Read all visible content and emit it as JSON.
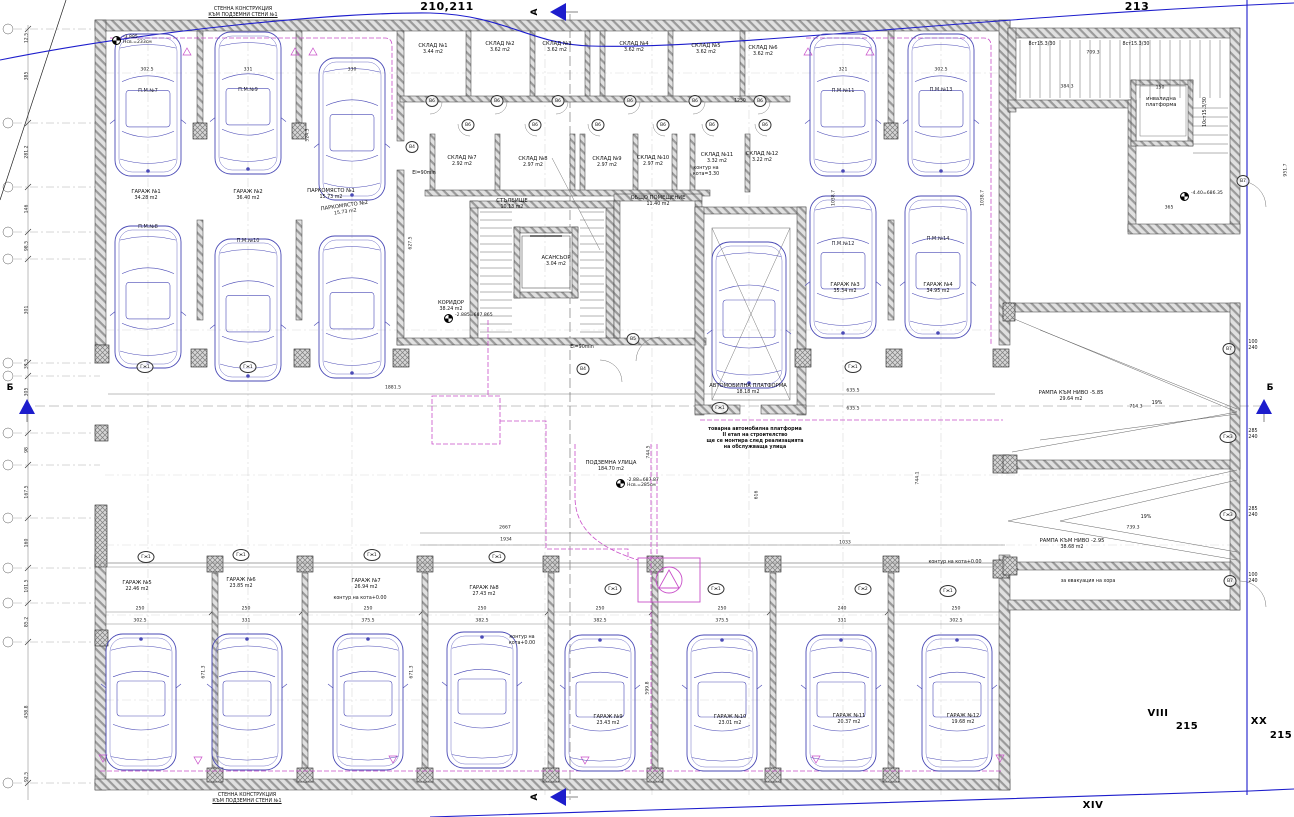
{
  "colors": {
    "car": "#4a4ab6",
    "duct": "#c94fc9",
    "boundary": "#1d1dcc",
    "wall_hatch": "#9a9a9a",
    "line": "#444444"
  },
  "plot_labels": [
    {
      "text": "210,211",
      "x": 447,
      "y": 0,
      "size": 11
    },
    {
      "text": "213",
      "x": 1137,
      "y": 0,
      "size": 11
    },
    {
      "text": "VIII",
      "x": 1158,
      "y": 708,
      "size": 10
    },
    {
      "text": "215",
      "x": 1187,
      "y": 721,
      "size": 10
    },
    {
      "text": "XX",
      "x": 1259,
      "y": 716,
      "size": 10
    },
    {
      "text": "215",
      "x": 1281,
      "y": 730,
      "size": 10
    },
    {
      "text": "XIV",
      "x": 1093,
      "y": 800,
      "size": 10
    }
  ],
  "section_markers": [
    {
      "label": "А",
      "lx": 535,
      "ly": 12,
      "tx": 556,
      "ty": 12,
      "dir": "left",
      "rot": true
    },
    {
      "label": "А",
      "lx": 535,
      "ly": 797,
      "tx": 556,
      "ty": 797,
      "dir": "left",
      "rot": true
    },
    {
      "label": "Б",
      "lx": 10,
      "ly": 388,
      "tx": 27,
      "ty": 406,
      "dir": "up",
      "rot": false
    },
    {
      "label": "Б",
      "lx": 1270,
      "ly": 388,
      "tx": 1264,
      "ty": 406,
      "dir": "up",
      "rot": false
    }
  ],
  "rooms": [
    {
      "name": "СКЛАД №1",
      "area": "3.44 m2",
      "x": 433,
      "y": 44
    },
    {
      "name": "СКЛАД №2",
      "area": "3.62 m2",
      "x": 500,
      "y": 42
    },
    {
      "name": "СКЛАД №3",
      "area": "3.62 m2",
      "x": 557,
      "y": 42
    },
    {
      "name": "СКЛАД №4",
      "area": "3.62 m2",
      "x": 634,
      "y": 42
    },
    {
      "name": "СКЛАД №5",
      "area": "3.62 m2",
      "x": 706,
      "y": 44
    },
    {
      "name": "СКЛАД №6",
      "area": "3.62 m2",
      "x": 763,
      "y": 46
    },
    {
      "name": "СКЛАД №7",
      "area": "2.92 m2",
      "x": 462,
      "y": 156
    },
    {
      "name": "СКЛАД №8",
      "area": "2.97 m2",
      "x": 533,
      "y": 157
    },
    {
      "name": "СКЛАД №9",
      "area": "2.97 m2",
      "x": 607,
      "y": 157
    },
    {
      "name": "СКЛАД №10",
      "area": "2.97 m2",
      "x": 653,
      "y": 156
    },
    {
      "name": "СКЛАД №11",
      "area": "3.32 m2",
      "x": 717,
      "y": 153
    },
    {
      "name": "СКЛАД №12",
      "area": "3.22 m2",
      "x": 762,
      "y": 152
    },
    {
      "name": "СТЪЛБИЩЕ",
      "area": "10.13 m2",
      "x": 512,
      "y": 199
    },
    {
      "name": "АСАНСЬОР",
      "area": "3.04 m2",
      "x": 556,
      "y": 256
    },
    {
      "name": "ОБЩО ПОМЕЩЕНИЕ",
      "area": "11.40 m2",
      "x": 658,
      "y": 196
    },
    {
      "name": "КОРИДОР",
      "area": "38.24 m2",
      "x": 451,
      "y": 301
    },
    {
      "name": "АВТОМОБИЛНА ПЛАТФОРМА",
      "area": "18.18 m2",
      "x": 748,
      "y": 384
    },
    {
      "name": "ПОДЗЕМНА УЛИЦА",
      "area": "184.70 m2",
      "x": 611,
      "y": 461
    },
    {
      "name": "РАМПА КЪМ НИВО -5.85",
      "area": "29.64 m2",
      "x": 1071,
      "y": 391
    },
    {
      "name": "РАМПА КЪМ НИВО -2.95",
      "area": "38.68 m2",
      "x": 1072,
      "y": 539
    },
    {
      "name": "ГАРАЖ №1",
      "area": "34.28 m2",
      "x": 146,
      "y": 190
    },
    {
      "name": "ГАРАЖ №2",
      "area": "36.40 m2",
      "x": 248,
      "y": 190
    },
    {
      "name": "ПАРКОМЯСТО №1",
      "area": "15.73 m2",
      "x": 331,
      "y": 189
    },
    {
      "name": "ПАРКОМЯСТО №2",
      "area": "15.73 m2",
      "x": 345,
      "y": 204,
      "rot": -8
    },
    {
      "name": "ГАРАЖ №3",
      "area": "35.34 m2",
      "x": 845,
      "y": 283
    },
    {
      "name": "ГАРАЖ №4",
      "area": "34.95 m2",
      "x": 938,
      "y": 283
    },
    {
      "name": "ГАРАЖ №5",
      "area": "22.46 m2",
      "x": 137,
      "y": 581
    },
    {
      "name": "ГАРАЖ №6",
      "area": "23.85 m2",
      "x": 241,
      "y": 578
    },
    {
      "name": "ГАРАЖ №7",
      "area": "26.94 m2",
      "x": 366,
      "y": 579
    },
    {
      "name": "ГАРАЖ №8",
      "area": "27.43 m2",
      "x": 484,
      "y": 586
    },
    {
      "name": "ГАРАЖ №9",
      "area": "23.43 m2",
      "x": 608,
      "y": 715
    },
    {
      "name": "ГАРАЖ №10",
      "area": "23.01 m2",
      "x": 730,
      "y": 715
    },
    {
      "name": "ГАРАЖ №11",
      "area": "20.37 m2",
      "x": 849,
      "y": 714
    },
    {
      "name": "ГАРАЖ №12",
      "area": "19.68 m2",
      "x": 963,
      "y": 714
    },
    {
      "name": "инвалидна\nплатформа",
      "area": "",
      "x": 1161,
      "y": 97
    }
  ],
  "cars": [
    {
      "cx": 148,
      "y": 32,
      "w": 66,
      "h": 146,
      "dir": "d",
      "label": "П.М.№7",
      "ly": 88
    },
    {
      "cx": 248,
      "y": 30,
      "w": 66,
      "h": 146,
      "dir": "d",
      "label": "П.М.№9",
      "ly": 87
    },
    {
      "cx": 352,
      "y": 56,
      "w": 66,
      "h": 146,
      "dir": "d",
      "label": "",
      "ly": 0
    },
    {
      "cx": 148,
      "y": 224,
      "w": 66,
      "h": 146,
      "dir": "d",
      "label": "П.М.№8",
      "ly": 224
    },
    {
      "cx": 248,
      "y": 237,
      "w": 66,
      "h": 146,
      "dir": "d",
      "label": "П.М.№10",
      "ly": 238
    },
    {
      "cx": 352,
      "y": 234,
      "w": 66,
      "h": 146,
      "dir": "d",
      "label": "",
      "ly": 0
    },
    {
      "cx": 843,
      "y": 32,
      "w": 66,
      "h": 146,
      "dir": "d",
      "label": "П.М.№11",
      "ly": 88
    },
    {
      "cx": 941,
      "y": 32,
      "w": 66,
      "h": 146,
      "dir": "d",
      "label": "П.М.№13",
      "ly": 87
    },
    {
      "cx": 843,
      "y": 194,
      "w": 66,
      "h": 146,
      "dir": "d",
      "label": "П.М.№12",
      "ly": 241
    },
    {
      "cx": 938,
      "y": 194,
      "w": 66,
      "h": 146,
      "dir": "d",
      "label": "П.М.№14",
      "ly": 236
    },
    {
      "cx": 749,
      "y": 240,
      "w": 74,
      "h": 150,
      "dir": "d",
      "label": "",
      "ly": 0
    },
    {
      "cx": 141,
      "y": 632,
      "w": 70,
      "h": 140,
      "dir": "u",
      "label": "",
      "ly": 0
    },
    {
      "cx": 247,
      "y": 632,
      "w": 70,
      "h": 140,
      "dir": "u",
      "label": "",
      "ly": 0
    },
    {
      "cx": 368,
      "y": 632,
      "w": 70,
      "h": 140,
      "dir": "u",
      "label": "",
      "ly": 0
    },
    {
      "cx": 482,
      "y": 630,
      "w": 70,
      "h": 140,
      "dir": "u",
      "label": "",
      "ly": 0
    },
    {
      "cx": 600,
      "y": 633,
      "w": 70,
      "h": 140,
      "dir": "u",
      "label": "",
      "ly": 0
    },
    {
      "cx": 722,
      "y": 633,
      "w": 70,
      "h": 140,
      "dir": "u",
      "label": "",
      "ly": 0
    },
    {
      "cx": 841,
      "y": 633,
      "w": 70,
      "h": 140,
      "dir": "u",
      "label": "",
      "ly": 0
    },
    {
      "cx": 957,
      "y": 633,
      "w": 70,
      "h": 140,
      "dir": "u",
      "label": "",
      "ly": 0
    }
  ],
  "door_tags": [
    {
      "t": "В6",
      "x": 432,
      "y": 101
    },
    {
      "t": "В6",
      "x": 497,
      "y": 101
    },
    {
      "t": "В6",
      "x": 558,
      "y": 101
    },
    {
      "t": "В6",
      "x": 630,
      "y": 101
    },
    {
      "t": "В6",
      "x": 695,
      "y": 101
    },
    {
      "t": "В6",
      "x": 760,
      "y": 101
    },
    {
      "t": "В6",
      "x": 468,
      "y": 125
    },
    {
      "t": "В6",
      "x": 535,
      "y": 125
    },
    {
      "t": "В6",
      "x": 598,
      "y": 125
    },
    {
      "t": "В6",
      "x": 663,
      "y": 125
    },
    {
      "t": "В6",
      "x": 712,
      "y": 125
    },
    {
      "t": "В6",
      "x": 765,
      "y": 125
    },
    {
      "t": "В4",
      "x": 412,
      "y": 147
    },
    {
      "t": "В4",
      "x": 583,
      "y": 369
    },
    {
      "t": "В5",
      "x": 633,
      "y": 339
    },
    {
      "t": "В7",
      "x": 1243,
      "y": 181
    },
    {
      "t": "В7",
      "x": 1229,
      "y": 349
    },
    {
      "t": "В7",
      "x": 1230,
      "y": 581
    },
    {
      "t": "Гж3",
      "x": 1228,
      "y": 437
    },
    {
      "t": "Гж3",
      "x": 1228,
      "y": 515
    },
    {
      "t": "Гж1",
      "x": 146,
      "y": 557
    },
    {
      "t": "Гж1",
      "x": 241,
      "y": 555
    },
    {
      "t": "Гж1",
      "x": 372,
      "y": 555
    },
    {
      "t": "Гж1",
      "x": 497,
      "y": 557
    },
    {
      "t": "Гж1",
      "x": 613,
      "y": 589
    },
    {
      "t": "Гж1",
      "x": 716,
      "y": 589
    },
    {
      "t": "Гж2",
      "x": 863,
      "y": 589
    },
    {
      "t": "Гж1",
      "x": 948,
      "y": 591
    },
    {
      "t": "Гж1",
      "x": 145,
      "y": 367
    },
    {
      "t": "Гж1",
      "x": 248,
      "y": 367
    },
    {
      "t": "Гж1",
      "x": 720,
      "y": 408
    },
    {
      "t": "Гж1",
      "x": 853,
      "y": 367
    }
  ],
  "elevation_marks": [
    {
      "v": "-3.885",
      "s": "Нсв.=233см",
      "x": 112,
      "y": 40
    },
    {
      "v": "-2.885=687.865",
      "s": "",
      "x": 444,
      "y": 318
    },
    {
      "v": "-2.88=687.87",
      "s": "Нсв.=285см",
      "x": 616,
      "y": 483
    },
    {
      "v": "-4.40=686.35",
      "s": "",
      "x": 1180,
      "y": 196
    }
  ],
  "notes": [
    {
      "text": "СТЕННА КОНСТРУКЦИЯ\nКЪМ ПОДЗЕМНИ СТЕНИ №1",
      "x": 243,
      "y": 7,
      "u": true
    },
    {
      "text": "СТЕННА КОНСТРУКЦИЯ\nКЪМ ПОДЗЕМНИ СТЕНИ №1",
      "x": 247,
      "y": 793,
      "u": true
    },
    {
      "text": "товарна автомобилна платформа\nII етап на строителство\nще се монтира след реализацията\nна обслужваща улица",
      "x": 755,
      "y": 427,
      "bold": true
    },
    {
      "text": "контур на\nкота=3.30",
      "x": 706,
      "y": 166
    },
    {
      "text": "контур на\nкота+0.00",
      "x": 522,
      "y": 635
    },
    {
      "text": "контур на кота+0.00",
      "x": 360,
      "y": 596
    },
    {
      "text": "контур на кота+0.00",
      "x": 955,
      "y": 560
    },
    {
      "text": "за евакуация на хора",
      "x": 1088,
      "y": 579
    },
    {
      "text": "EI=90min",
      "x": 424,
      "y": 171
    },
    {
      "text": "EI=90min",
      "x": 582,
      "y": 345
    },
    {
      "text": "8ст15.3/30",
      "x": 1042,
      "y": 42
    },
    {
      "text": "8ст15.3/30",
      "x": 1136,
      "y": 42
    },
    {
      "text": "10ст15.3/30",
      "x": 1206,
      "y": 112,
      "rot": true
    },
    {
      "text": "19%",
      "x": 1157,
      "y": 401
    },
    {
      "text": "19%",
      "x": 1146,
      "y": 515
    },
    {
      "text": "100\n240",
      "x": 1253,
      "y": 340
    },
    {
      "text": "285\n240",
      "x": 1253,
      "y": 429
    },
    {
      "text": "285\n240",
      "x": 1253,
      "y": 507
    },
    {
      "text": "100\n240",
      "x": 1253,
      "y": 573
    }
  ],
  "dimensions": [
    {
      "t": "1881.5",
      "x": 393,
      "y": 388
    },
    {
      "t": "635.5",
      "x": 853,
      "y": 391
    },
    {
      "t": "635.5",
      "x": 853,
      "y": 409
    },
    {
      "t": "2667",
      "x": 505,
      "y": 528
    },
    {
      "t": "1934",
      "x": 506,
      "y": 540
    },
    {
      "t": "1033",
      "x": 845,
      "y": 543
    },
    {
      "t": "714.3",
      "x": 1136,
      "y": 407
    },
    {
      "t": "739.3",
      "x": 1133,
      "y": 528
    },
    {
      "t": "384.3",
      "x": 1067,
      "y": 87
    },
    {
      "t": "709.3",
      "x": 1093,
      "y": 53
    },
    {
      "t": "365",
      "x": 1169,
      "y": 208
    },
    {
      "t": "1250",
      "x": 740,
      "y": 101
    },
    {
      "t": "150",
      "x": 1160,
      "y": 88
    },
    {
      "t": "744.5",
      "x": 649,
      "y": 452,
      "rot": true
    },
    {
      "t": "616",
      "x": 757,
      "y": 495,
      "rot": true
    },
    {
      "t": "744.1",
      "x": 918,
      "y": 478,
      "rot": true
    },
    {
      "t": "1038.7",
      "x": 834,
      "y": 198,
      "rot": true
    },
    {
      "t": "1038.7",
      "x": 983,
      "y": 198,
      "rot": true
    },
    {
      "t": "524.3",
      "x": 308,
      "y": 135,
      "rot": true
    },
    {
      "t": "627.5",
      "x": 411,
      "y": 243,
      "rot": true
    },
    {
      "t": "671.3",
      "x": 204,
      "y": 672,
      "rot": true
    },
    {
      "t": "671.3",
      "x": 412,
      "y": 672,
      "rot": true
    },
    {
      "t": "599.8",
      "x": 648,
      "y": 688,
      "rot": true
    },
    {
      "t": "951.7",
      "x": 1286,
      "y": 170,
      "rot": true
    },
    {
      "t": "12.5",
      "x": 27,
      "y": 38,
      "rot": true
    },
    {
      "t": "385",
      "x": 27,
      "y": 76,
      "rot": true
    },
    {
      "t": "281.2",
      "x": 27,
      "y": 152,
      "rot": true
    },
    {
      "t": "146",
      "x": 27,
      "y": 209,
      "rot": true
    },
    {
      "t": "98.5",
      "x": 27,
      "y": 246,
      "rot": true
    },
    {
      "t": "301",
      "x": 27,
      "y": 310,
      "rot": true
    },
    {
      "t": "37.5",
      "x": 27,
      "y": 364,
      "rot": true
    },
    {
      "t": "305",
      "x": 27,
      "y": 392,
      "rot": true
    },
    {
      "t": "98",
      "x": 27,
      "y": 450,
      "rot": true
    },
    {
      "t": "167.5",
      "x": 27,
      "y": 492,
      "rot": true
    },
    {
      "t": "160",
      "x": 27,
      "y": 543,
      "rot": true
    },
    {
      "t": "101.5",
      "x": 27,
      "y": 586,
      "rot": true
    },
    {
      "t": "85.2",
      "x": 27,
      "y": 622,
      "rot": true
    },
    {
      "t": "458.8",
      "x": 27,
      "y": 712,
      "rot": true
    },
    {
      "t": "92.5",
      "x": 27,
      "y": 777,
      "rot": true
    },
    {
      "t": "302.5",
      "x": 147,
      "y": 70
    },
    {
      "t": "331",
      "x": 248,
      "y": 70
    },
    {
      "t": "330",
      "x": 352,
      "y": 70
    },
    {
      "t": "321",
      "x": 843,
      "y": 70
    },
    {
      "t": "302.5",
      "x": 941,
      "y": 70
    },
    {
      "t": "250",
      "x": 140,
      "y": 609
    },
    {
      "t": "250",
      "x": 246,
      "y": 609
    },
    {
      "t": "250",
      "x": 368,
      "y": 609
    },
    {
      "t": "250",
      "x": 482,
      "y": 609
    },
    {
      "t": "250",
      "x": 600,
      "y": 609
    },
    {
      "t": "250",
      "x": 722,
      "y": 609
    },
    {
      "t": "240",
      "x": 842,
      "y": 609
    },
    {
      "t": "250",
      "x": 956,
      "y": 609
    },
    {
      "t": "302.5",
      "x": 140,
      "y": 621
    },
    {
      "t": "331",
      "x": 246,
      "y": 621
    },
    {
      "t": "375.5",
      "x": 368,
      "y": 621
    },
    {
      "t": "382.5",
      "x": 482,
      "y": 621
    },
    {
      "t": "382.5",
      "x": 600,
      "y": 621
    },
    {
      "t": "375.5",
      "x": 722,
      "y": 621
    },
    {
      "t": "331",
      "x": 842,
      "y": 621
    },
    {
      "t": "302.5",
      "x": 956,
      "y": 621
    }
  ]
}
